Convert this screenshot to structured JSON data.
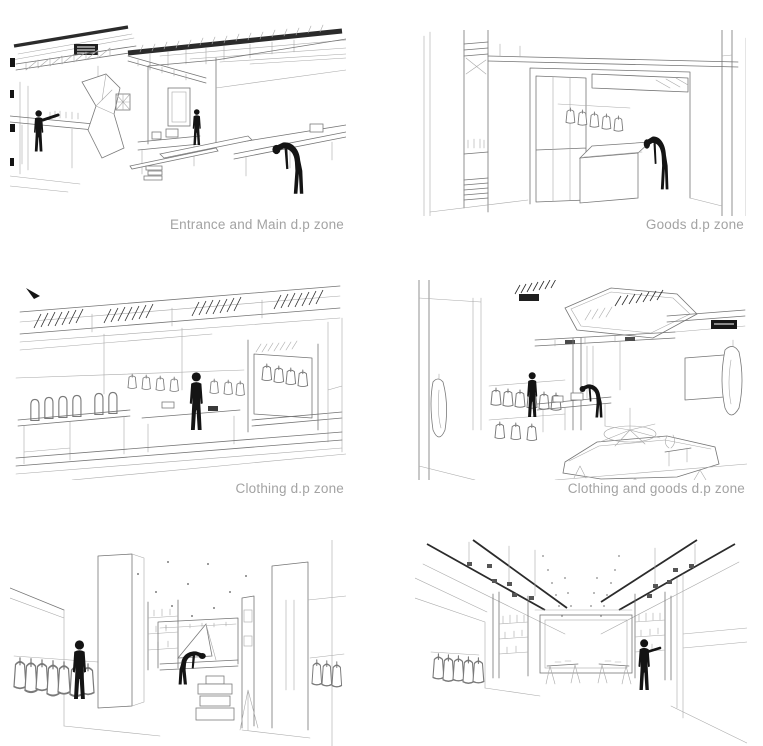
{
  "sheet": {
    "background": "#ffffff",
    "line_color": "#757575",
    "dark_line_color": "#2b2b2b",
    "caption_color": "#a3a3a3",
    "silhouette_color": "#141414"
  },
  "panels": [
    {
      "name": "entrance-and-main-dp-zone",
      "caption": "Entrance and Main d.p zone"
    },
    {
      "name": "goods-dp-zone",
      "caption": "Goods d.p zone"
    },
    {
      "name": "clothing-dp-zone",
      "caption": "Clothing d.p zone"
    },
    {
      "name": "clothing-and-goods-dp-zone",
      "caption": "Clothing and goods d.p zone"
    },
    {
      "name": "fitting-aisle-view",
      "caption": ""
    },
    {
      "name": "corridor-shelves-view",
      "caption": ""
    }
  ]
}
